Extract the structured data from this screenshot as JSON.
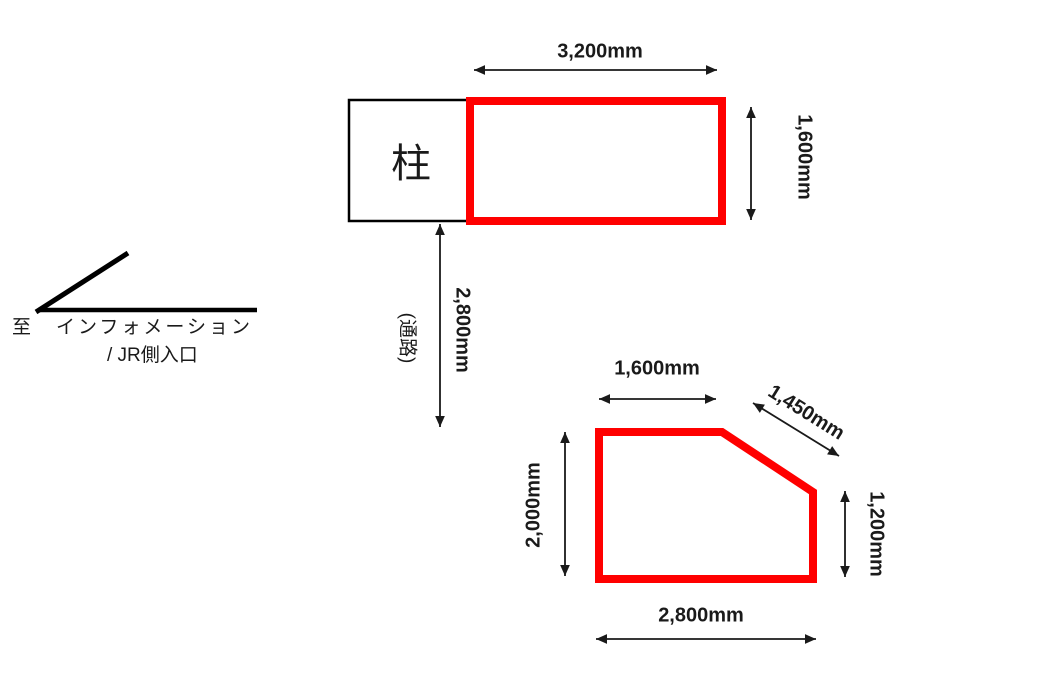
{
  "diagram": {
    "description_labels": {
      "pillar": "柱",
      "passage": "(通路)",
      "nav_line1": "至　インフォメーション",
      "nav_line2": "/ JR側入口"
    },
    "dimensions": {
      "top_rect_width": "3,200mm",
      "top_rect_height": "1,600mm",
      "passage_length": "2,800mm",
      "poly_top": "1,600mm",
      "poly_diagonal": "1,450mm",
      "poly_left": "2,000mm",
      "poly_right": "1,200mm",
      "poly_bottom": "2,800mm"
    },
    "colors": {
      "shape_red": "#ff0000",
      "line_black": "#000000",
      "dim_line": "#1a1a1a"
    }
  }
}
